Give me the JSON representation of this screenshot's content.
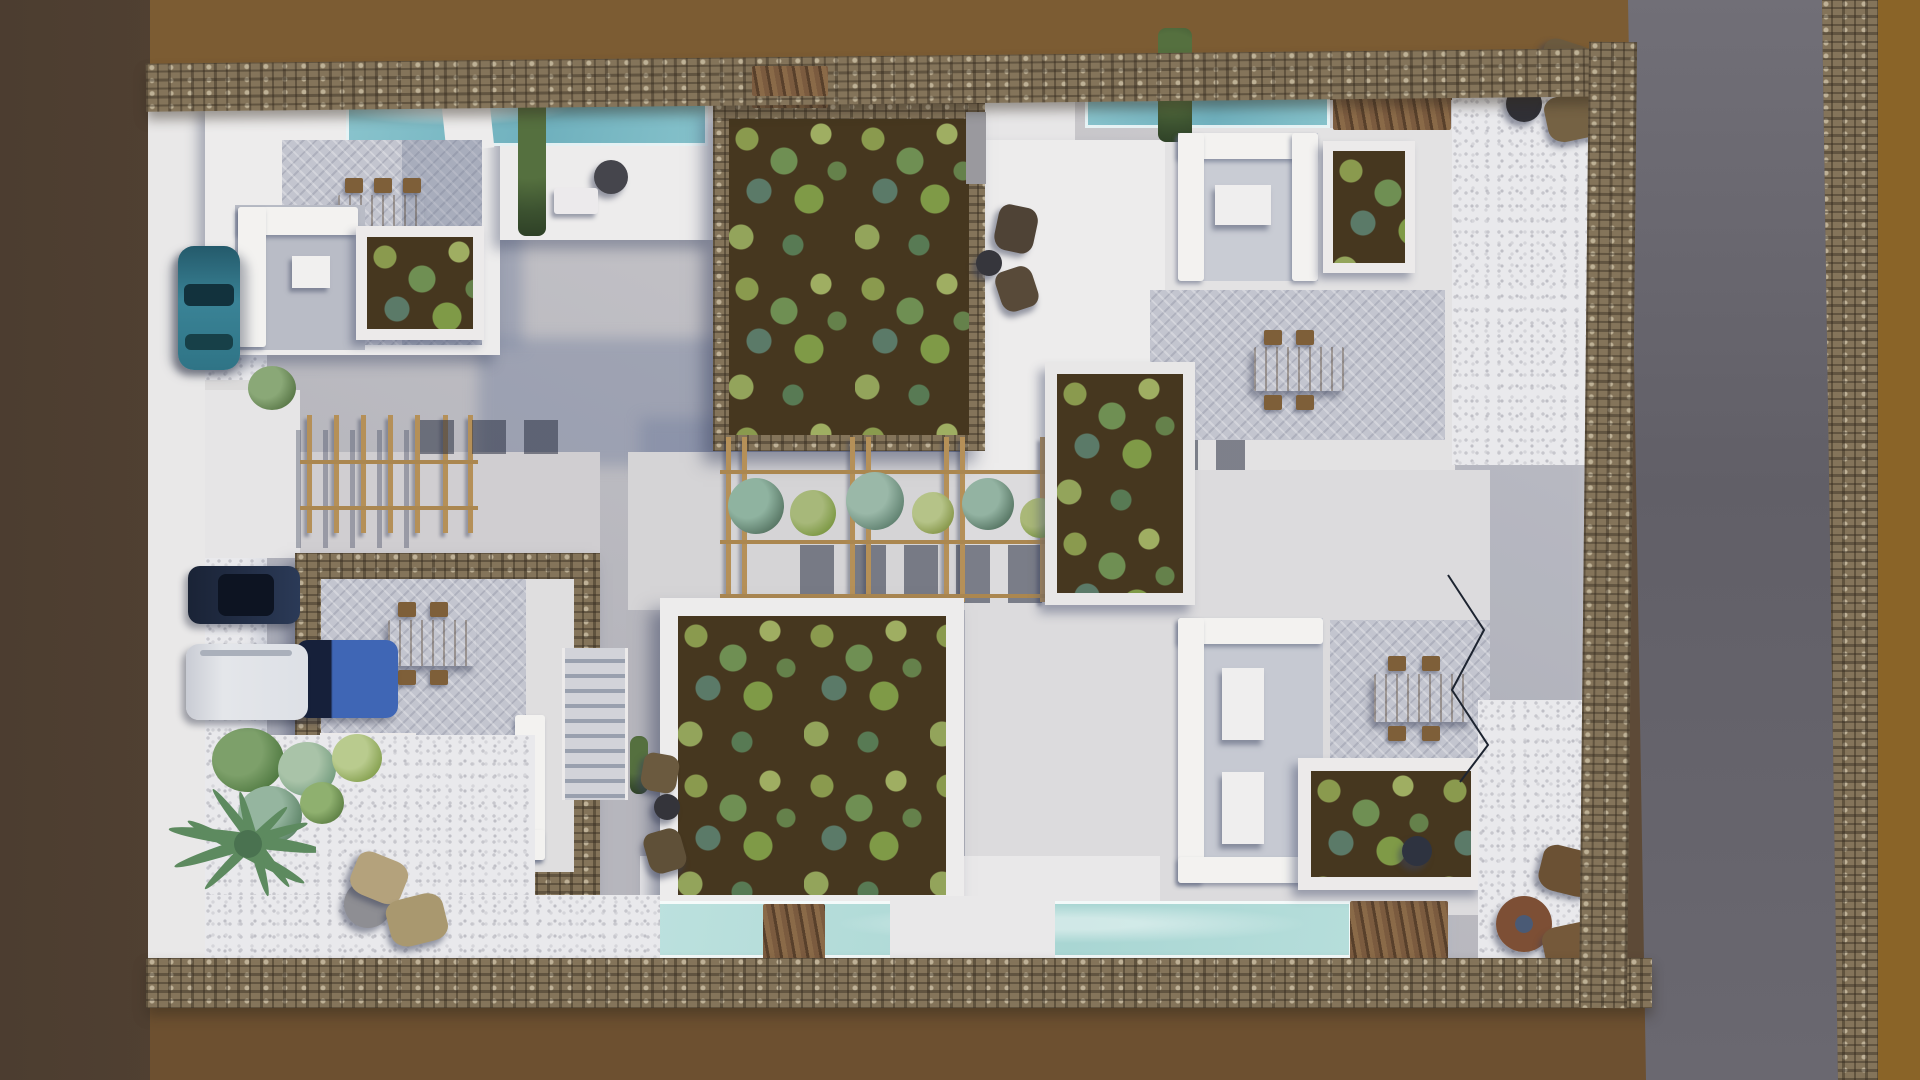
{
  "scene": {
    "title": "Aerial top-down 3D render of a whitewashed villa complex with planted green roofs",
    "view": "top-down architectural visualization",
    "labels": {
      "earth_left": "bare earth surrounding the site (west)",
      "earth_top": "graded earth strip (north)",
      "earth_right": "bare earth beyond roadside wall (east)",
      "earth_bottom": "bare earth strip (south)",
      "road": "asphalt road running along the east side",
      "wall_top": "dry-stone perimeter wall (north)",
      "wall_bottom": "dry-stone perimeter wall (south)",
      "wall_east": "dry-stone perimeter wall (east)",
      "wall_roadside": "dry-stone wall east of the road",
      "compound": "villa compound plaza and walkways",
      "gate_top": "timber gate in the north wall",
      "green_roof_north": "large planted green roof with stone parapet",
      "green_roof_center": "large planted green roof with white parapet",
      "green_patch": "planted roof patch with shrubs",
      "pool_north": "north pool terrace",
      "pool_northeast": "northeast lap pool",
      "pool_south": "south pool terrace",
      "pergola_west": "timber pergola over west walkway",
      "pergola_center": "planted timber pergola across central walkway",
      "courtyard": "stone-walled courtyard villa",
      "stairs": "external stair beside the courtyard",
      "dining_set": "timber dining table with chairs",
      "sunken_lounge": "sunken lounge with white sofas",
      "l_sofa": "L-shaped white lounge sofa",
      "pouf_cluster": "lounge poufs with side table",
      "gravel_court": "white pebble court",
      "agave": "agave and shrub garden",
      "hedge": "clipped hedge strip",
      "sun_deck": "sun deck with lounger and parasol table",
      "wire_fence": "thin wire garden fence"
    }
  },
  "palette": {
    "earth_dark": "#584635",
    "earth_top": "#7c5c33",
    "earth_right": "#8a6428",
    "earth_bottom": "#6d5030",
    "road_asphalt": "#67656d",
    "stone_wall": "#84745a",
    "concrete_plaza": "#c9c7ca",
    "roof_white": "#edecec",
    "shadow_blue": "#8e96ad",
    "paving_herringbone": "#c3c5cf",
    "gravel_white": "#e9e9ec",
    "pool_turquoise": "#7fb9c4",
    "pool_pale": "#b9dfdc",
    "soil": "#46371f",
    "foliage_olive": "#8a9a4e",
    "foliage_teal": "#5b7a68",
    "wood_table": "#9b7a4b",
    "wood_beam": "#b59058",
    "wood_fence": "#7b5b3f",
    "car_teal": "#2f7486",
    "car_navy": "#232f47",
    "van_white": "#e0e3e8",
    "car_blue": "#3f66b5",
    "pouf_dark": "#57452f",
    "pouf_beige": "#b4a27c"
  },
  "vehicles": [
    {
      "label": "teal hatchback parked on the west verge",
      "color": "#2f7486"
    },
    {
      "label": "navy SUV parked on the west verge",
      "color": "#232f47"
    },
    {
      "label": "white camper van parked on the west verge",
      "color": "#e0e3e8"
    },
    {
      "label": "blue car parked beside the van",
      "color": "#3f66b5"
    }
  ],
  "counts": {
    "large_green_roofs": 2,
    "small_green_patches": 5,
    "dining_sets": 4,
    "sunken_lounges": 2,
    "l_shaped_sofas": 2,
    "pouf_clusters": 5,
    "pools": 3,
    "pergolas": 2,
    "parked_vehicles": 4
  }
}
